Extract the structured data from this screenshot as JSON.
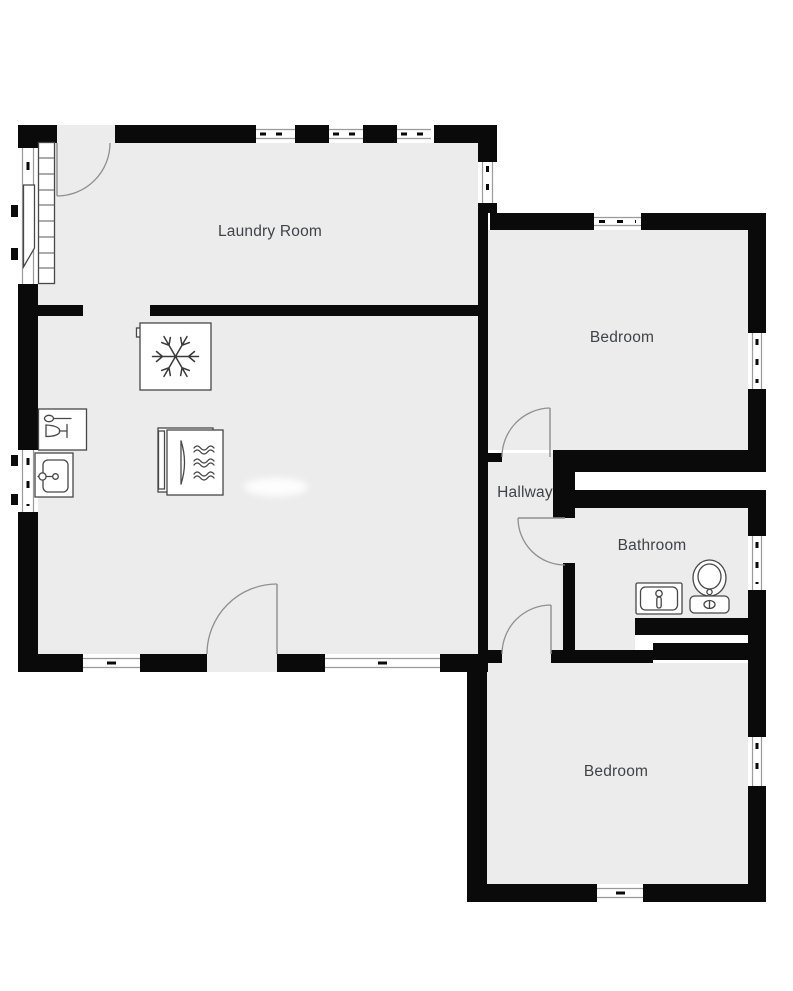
{
  "plan": {
    "type": "residential-floor-plan",
    "colors": {
      "background": "#ffffff",
      "floor": "#ececec",
      "wall": "#0a0a0a",
      "label": "#3f4347",
      "door_arc": "#8f8f8f",
      "window_frame": "#9a9a9a"
    },
    "rooms": {
      "laundry": {
        "label": "Laundry Room"
      },
      "bedroom_top": {
        "label": "Bedroom"
      },
      "hallway": {
        "label": "Hallway"
      },
      "bathroom": {
        "label": "Bathroom"
      },
      "bedroom_bottom": {
        "label": "Bedroom"
      }
    },
    "fixtures": [
      "freezer",
      "oven",
      "dishwasher",
      "kitchen-sink",
      "bathroom-sink",
      "toilet",
      "radiator",
      "casement-window"
    ],
    "icons": {
      "freezer": "snowflake-icon",
      "oven": "heat-waves-icon",
      "dishwasher": "glass-and-spoon-icon",
      "kitchen_sink": "basin-faucet-icon",
      "bathroom_sink": "basin-faucet-icon",
      "toilet": "toilet-icon"
    },
    "doors_count": 5,
    "windows_count": 13
  }
}
